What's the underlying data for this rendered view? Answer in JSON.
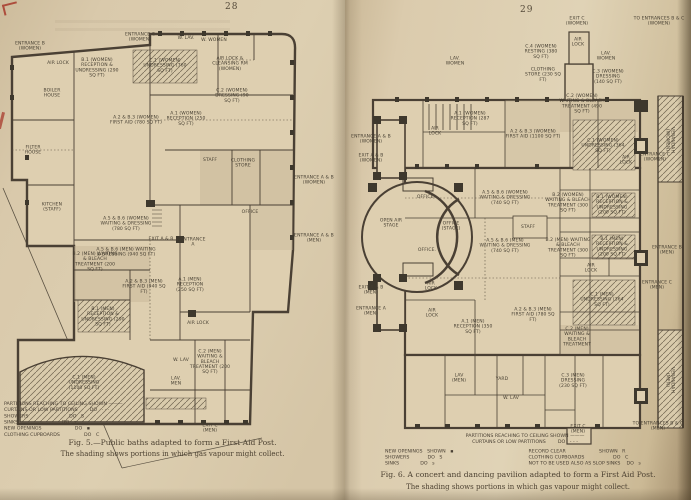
{
  "meta": {
    "paper_color": "#dccdb0",
    "plan_fill_color": "#decfb0",
    "ink_color": "#4a4034",
    "hatch_color": "#6f6450",
    "red_ink_color": "#a83a2c"
  },
  "left_page": {
    "page_number": "28",
    "caption_line1": "Fig. 5.—Public baths adapted to form a First Aid Post.",
    "caption_line2": "The shading shows portions in which gas vapour might collect.",
    "legend_lines": [
      "PARTITIONS REACHING TO CEILING SHOWN ———",
      "CURTAINS OR LOW PARTITIONS        DO   · · ·",
      "SHOWERS                           DO   S",
      "SINKS                             DO   s",
      "NEW OPENINGS                      DO   ▪",
      "CLOTHING CUPBOARDS                DO   C"
    ],
    "labels": [
      {
        "t": "ENTRANCE B (WOMEN)",
        "x": 30,
        "y": 46,
        "w": 42
      },
      {
        "t": "AIR LOCK",
        "x": 58,
        "y": 63,
        "w": 22
      },
      {
        "t": "B.1 (WOMEN) RECEPTION & UNDRESSING (290 SQ FT)",
        "x": 97,
        "y": 68,
        "w": 46
      },
      {
        "t": "ENTRANCE C (WOMEN)",
        "x": 140,
        "y": 37,
        "w": 44
      },
      {
        "t": "C.1 (WOMEN) UNDRESSING (760 SQ FT)",
        "x": 165,
        "y": 66,
        "w": 48
      },
      {
        "t": "W. LAV.",
        "x": 186,
        "y": 38,
        "w": 20
      },
      {
        "t": "W. WOMEN",
        "x": 214,
        "y": 40,
        "w": 26
      },
      {
        "t": "AIR LOCK & CLEANSING RM (WOMEN)",
        "x": 230,
        "y": 64,
        "w": 46
      },
      {
        "t": "C.2 (WOMEN) DRESSING (90 SQ FT)",
        "x": 232,
        "y": 96,
        "w": 40
      },
      {
        "t": "BOILER HOUSE",
        "x": 52,
        "y": 93,
        "w": 30
      },
      {
        "t": "FILTER HOUSE",
        "x": 33,
        "y": 150,
        "w": 30
      },
      {
        "t": "KITCHEN (STAFF)",
        "x": 52,
        "y": 207,
        "w": 36
      },
      {
        "t": "A.2 & B.3 (WOMEN) FIRST AID (780 SQ FT)",
        "x": 136,
        "y": 120,
        "w": 58
      },
      {
        "t": "A.1 (WOMEN) RECEPTION (250 SQ FT)",
        "x": 186,
        "y": 119,
        "w": 42
      },
      {
        "t": "STAFF",
        "x": 210,
        "y": 160,
        "w": 20
      },
      {
        "t": "CLOTHING STORE",
        "x": 243,
        "y": 163,
        "w": 30
      },
      {
        "t": "A.5 & B.6 (WOMEN) WAITING & DRESSING (780 SQ FT)",
        "x": 126,
        "y": 224,
        "w": 60
      },
      {
        "t": "EXIT A & B",
        "x": 161,
        "y": 239,
        "w": 26
      },
      {
        "t": "ENTRANCE A",
        "x": 193,
        "y": 242,
        "w": 28
      },
      {
        "t": "OFFICE",
        "x": 250,
        "y": 212,
        "w": 24
      },
      {
        "t": "ENTRANCE A & B (WOMEN)",
        "x": 314,
        "y": 180,
        "w": 44
      },
      {
        "t": "ENTRANCE A & B (MEN)",
        "x": 314,
        "y": 238,
        "w": 44
      },
      {
        "t": "B.2 (MEN) WAITING & BLEACH TREATMENT (200 SQ FT)",
        "x": 95,
        "y": 262,
        "w": 46
      },
      {
        "t": "A.5 & B.6 (MEN) WAITING & DRESSING (940 SQ FT)",
        "x": 126,
        "y": 252,
        "w": 60
      },
      {
        "t": "A.2 & B.3 (MEN) FIRST AID (940 SQ FT)",
        "x": 144,
        "y": 287,
        "w": 48
      },
      {
        "t": "B.1 (MEN) RECEPTION & UNDRESSING (290 SQ FT)",
        "x": 103,
        "y": 317,
        "w": 46
      },
      {
        "t": "A.1 (MEN) RECEPTION (250 SQ FT)",
        "x": 190,
        "y": 285,
        "w": 38
      },
      {
        "t": "AIR LOCK",
        "x": 198,
        "y": 323,
        "w": 22
      },
      {
        "t": "C.1 (MEN) UNDRESSING (1100 SQ FT)",
        "x": 84,
        "y": 383,
        "w": 44
      },
      {
        "t": "W. LAV",
        "x": 181,
        "y": 360,
        "w": 18
      },
      {
        "t": "LAV. MEN",
        "x": 176,
        "y": 381,
        "w": 20
      },
      {
        "t": "C.2 (MEN) WAITING & BLEACH TREATMENT (200 SQ FT)",
        "x": 210,
        "y": 362,
        "w": 44
      },
      {
        "t": "EXIT C (MEN)",
        "x": 210,
        "y": 428,
        "w": 30
      }
    ]
  },
  "right_page": {
    "page_number": "29",
    "caption_line1": "Fig. 6.  A concert and dancing pavilion adapted to form a First Aid Post.",
    "caption_line2": "The shading shows portions in which gas vapour might collect.",
    "legend_header": [
      "PARTITIONS REACHING TO CEILING SHOWN ———",
      "CURTAINS OR LOW PARTITIONS        DO   - - -"
    ],
    "legend_col_left": [
      "NEW OPENINGS   SHOWN   ▪",
      "SHOWERS            DO   S",
      "SINKS              DO   s"
    ],
    "legend_col_right": [
      "RECORD CLEAR                      SHOWN   R",
      "CLOTHING CUPBOARDS                   DO   C",
      "NOT TO BE USED ALSO AS SLOP SINKS    DO   s"
    ],
    "labels": [
      {
        "t": "EXIT C (WOMEN)",
        "x": 232,
        "y": 21,
        "w": 36
      },
      {
        "t": "TO ENTRANCES B & C (WOMEN)",
        "x": 314,
        "y": 21,
        "w": 56
      },
      {
        "t": "AIR LOCK",
        "x": 233,
        "y": 42,
        "w": 20
      },
      {
        "t": "LAV. WOMEN",
        "x": 110,
        "y": 61,
        "w": 26
      },
      {
        "t": "C.4 (WOMEN) RESTING (380 SQ FT)",
        "x": 196,
        "y": 52,
        "w": 40
      },
      {
        "t": "CLOTHING STORE (230 SQ FT)",
        "x": 198,
        "y": 75,
        "w": 38
      },
      {
        "t": "LAV. WOMEN",
        "x": 261,
        "y": 56,
        "w": 24
      },
      {
        "t": "C.3 (WOMEN) DRESSING (140 SQ FT)",
        "x": 263,
        "y": 77,
        "w": 36
      },
      {
        "t": "VERANDAH (WOMEN)",
        "x": 325,
        "y": 140,
        "w": 44,
        "r": 90
      },
      {
        "t": "ENTRANCE A & B (WOMEN)",
        "x": 26,
        "y": 139,
        "w": 44
      },
      {
        "t": "EXIT A & B (WOMEN)",
        "x": 26,
        "y": 158,
        "w": 40
      },
      {
        "t": "AIR LOCK",
        "x": 90,
        "y": 131,
        "w": 20
      },
      {
        "t": "A.1 (WOMEN) RECEPTION (287 SQ FT)",
        "x": 125,
        "y": 119,
        "w": 44
      },
      {
        "t": "A.2 & B.3 (WOMEN) FIRST AID (1100 SQ FT)",
        "x": 188,
        "y": 134,
        "w": 56
      },
      {
        "t": "C.2 (WOMEN) WAITING & BLEACH TREATMENT (490 SQ FT)",
        "x": 237,
        "y": 104,
        "w": 48
      },
      {
        "t": "C.1 (WOMEN) UNDRESSING (364 SQ FT)",
        "x": 258,
        "y": 146,
        "w": 44
      },
      {
        "t": "AIR LOCK",
        "x": 281,
        "y": 160,
        "w": 20
      },
      {
        "t": "ENTRANCE C (WOMEN)",
        "x": 310,
        "y": 157,
        "w": 38
      },
      {
        "t": "A.5 & B.6 (WOMEN) WAITING & DRESSING (740 SQ FT)",
        "x": 160,
        "y": 198,
        "w": 58
      },
      {
        "t": "B.2 (WOMEN) WAITING & BLEACH TREATMENT (300 SQ FT)",
        "x": 223,
        "y": 203,
        "w": 46
      },
      {
        "t": "B.1 (WOMEN) RECEPTION & UNDRESSING (200 SQ FT)",
        "x": 267,
        "y": 205,
        "w": 42
      },
      {
        "t": "STAFF",
        "x": 183,
        "y": 227,
        "w": 18
      },
      {
        "t": "A.5 & B.6 (MEN) WAITING & DRESSING (740 SQ FT)",
        "x": 160,
        "y": 246,
        "w": 58
      },
      {
        "t": "B.2 (MEN) WAITING & BLEACH TREATMENT (300 SQ FT)",
        "x": 223,
        "y": 248,
        "w": 46
      },
      {
        "t": "B.1 (MEN) RECEPTION & UNDRESSING (200 SQ FT)",
        "x": 267,
        "y": 247,
        "w": 42
      },
      {
        "t": "ENTRANCE B (MEN)",
        "x": 322,
        "y": 250,
        "w": 36
      },
      {
        "t": "AIR LOCK",
        "x": 246,
        "y": 268,
        "w": 20
      },
      {
        "t": "C.1 (MEN) UNDRESSING (364 SQ FT)",
        "x": 257,
        "y": 300,
        "w": 44
      },
      {
        "t": "ENTRANCE C (MEN)",
        "x": 312,
        "y": 285,
        "w": 36
      },
      {
        "t": "C.2 (MEN) WAITING & BLEACH TREATMENT",
        "x": 232,
        "y": 337,
        "w": 44
      },
      {
        "t": "OPEN AIR STAGE",
        "x": 46,
        "y": 223,
        "w": 30
      },
      {
        "t": "OFFICE.",
        "x": 81,
        "y": 197,
        "w": 24
      },
      {
        "t": "OFFICE (STAGE)",
        "x": 106,
        "y": 226,
        "w": 26
      },
      {
        "t": "OFFICE.",
        "x": 82,
        "y": 250,
        "w": 24
      },
      {
        "t": "EXIT A & B (MEN)",
        "x": 26,
        "y": 290,
        "w": 38
      },
      {
        "t": "ENTRANCE A (MEN)",
        "x": 26,
        "y": 311,
        "w": 40
      },
      {
        "t": "AIR LOCK",
        "x": 86,
        "y": 286,
        "w": 20
      },
      {
        "t": "AIR LOCK",
        "x": 87,
        "y": 313,
        "w": 20
      },
      {
        "t": "A.1 (MEN) RECEPTION (350 SQ FT)",
        "x": 128,
        "y": 327,
        "w": 42
      },
      {
        "t": "A.2 & B.3 (MEN) FIRST AID (780 SQ FT)",
        "x": 188,
        "y": 315,
        "w": 50
      },
      {
        "t": "LAV (MEN)",
        "x": 114,
        "y": 378,
        "w": 22
      },
      {
        "t": "YARD",
        "x": 157,
        "y": 379,
        "w": 18
      },
      {
        "t": "W. LAV",
        "x": 166,
        "y": 398,
        "w": 18
      },
      {
        "t": "C.3 (MEN) DRESSING (230 SQ FT)",
        "x": 228,
        "y": 381,
        "w": 36
      },
      {
        "t": "VERANDAH (MEN)",
        "x": 325,
        "y": 380,
        "w": 40,
        "r": 90
      },
      {
        "t": "EXIT C (MEN)",
        "x": 233,
        "y": 429,
        "w": 30
      },
      {
        "t": "TO ENTRANCES B & C (MEN)",
        "x": 313,
        "y": 426,
        "w": 52
      }
    ]
  }
}
